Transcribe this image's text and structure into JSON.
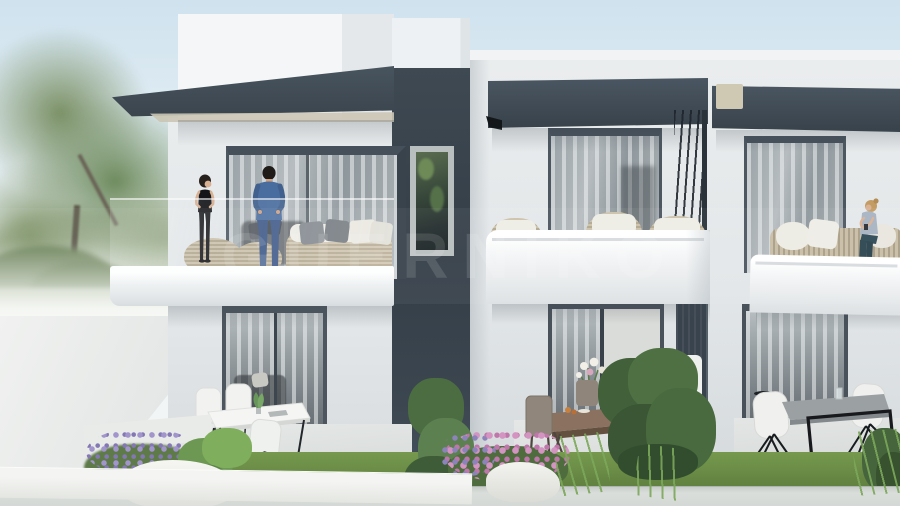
{
  "meta": {
    "kind": "3D architectural exterior render",
    "width_px": 900,
    "height_px": 506,
    "time_of_day": "overcast daylight, hazy white sky"
  },
  "watermark": {
    "text": "GUERNIKO",
    "style": "large translucent capital letters in a faint horizontal band across the image centre"
  },
  "building": {
    "storeys": 2,
    "style": "modern minimalist townhouse row, flat roofs",
    "facade_colors": {
      "walls": "#e8ebec",
      "charcoal_accents": "#3d4751",
      "balcony_fascia": "#f5f7f8"
    },
    "central_tower": "charcoal stair tower between units with tall narrow window reflecting greenery",
    "units": [
      {
        "id": "left",
        "upper": "projecting balcony with glass balustrade, charcoal cantilever canopy, wicker poufs and wicker sofa with white cushions and grey pillows, two people standing",
        "lower": "glazed sliding door with sheer curtains and grey sofa inside; patio with white dining table, white shell chairs with black legs, small potted plant"
      },
      {
        "id": "middle",
        "upper": "recessed balcony behind rounded white parapet, charcoal awning, three wicker tub chairs with white cushions and round wicker side table",
        "lower": "partially open glazed door showing bedroom with white bed and green pillow; patio with wooden dining table, four taupe chairs, vase of white flowers"
      },
      {
        "id": "right",
        "upper": "balcony with white parapet, charcoal awning with beige roller box, wicker sofa with white cushions, seated woman",
        "lower": "glazed door with sheer curtains and black stool inside; patio with grey-top table on black frame leg, white shell chairs with black spider legs, glass cup"
      }
    ]
  },
  "people": [
    {
      "location": "left balcony",
      "description": "woman standing, dark bob hair, black top, black trousers"
    },
    {
      "location": "left balcony",
      "description": "man standing facing her, dark hair, blue denim shirt and jeans"
    },
    {
      "location": "right balcony",
      "description": "blonde woman sitting on wicker sofa, grey-blue top, dark teal trousers"
    }
  ],
  "landscape": {
    "left": "large leafy green trees and hazy lawn behind a pale concrete walkway",
    "foreground": "white planter wall, lavender bushes, ferns, pink flowering shrubs, white rocks, ornamental grass tufts, green hedge, bright lawn strip and pale pavement along the bottom edge"
  },
  "palette": {
    "sky": "#dbe9f1",
    "wall_white": "#e8ebec",
    "charcoal": "#3d4751",
    "glass": "#9aa3a8",
    "wicker": "#c2b69e",
    "lawn": "#6b8d48",
    "lavender": "#9a8fc2",
    "pink_flowers": "#cf8fbd",
    "wood_table": "#8a7160"
  }
}
